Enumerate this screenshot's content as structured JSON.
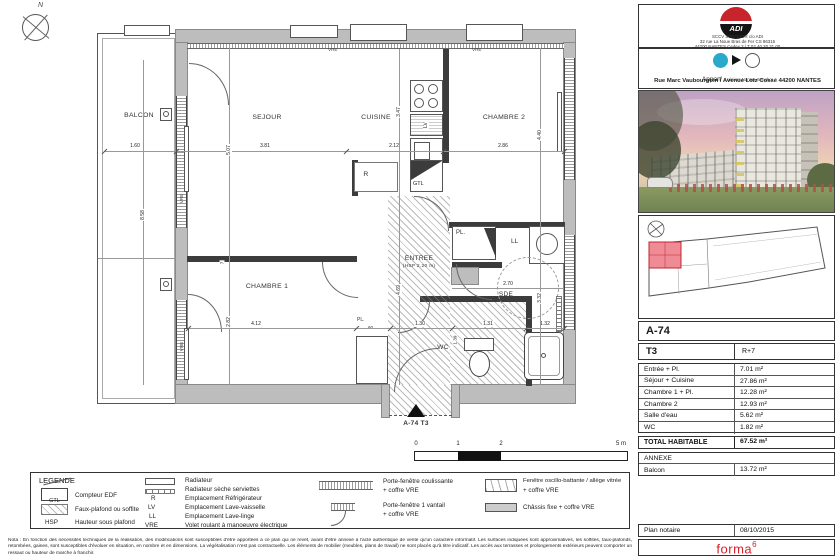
{
  "colors": {
    "accent_red": "#c8242c",
    "unit_highlight": "#ef8b95",
    "firm_red": "#d6212b"
  },
  "plan": {
    "north": "N",
    "rooms": {
      "balcon": "BALCON",
      "sejour": "SEJOUR",
      "cuisine": "CUISINE",
      "chambre2": "CHAMBRE 2",
      "chambre1": "CHAMBRE 1",
      "entree": "ENTREE",
      "entree_hsp": "(HSP 2.20 m)",
      "sde": "SDE",
      "wc": "WC",
      "pl_top": "PL.",
      "pl_bottom": "PL.",
      "pl_depth": "60",
      "ll": "LL",
      "refrigerator": "R",
      "lave_vaisselle": "LV",
      "gtl": "GTL"
    },
    "vre_label": "VRE",
    "dims": {
      "balcon_width": "1.60",
      "balcon_height": "8.58",
      "sejour_width": "3.81",
      "sejour_height": "5.07",
      "cuisine_width": "2.12",
      "cuisine_height": "3.47",
      "chambre2_width": "2.86",
      "chambre2_height": "4.40",
      "chambre1_width": "4.12",
      "chambre1_height": "2.82",
      "wall_offset": "7",
      "entree_height": "4.69",
      "entree_width": "1.30",
      "sde_width": "2.70",
      "sde_height": "3.32",
      "wc_width": "1.31",
      "wc_height": "1.39",
      "douche_width": "1.32"
    },
    "marker_label": "A-74 T3",
    "scale_ticks": [
      "0",
      "1",
      "2",
      "5 m"
    ]
  },
  "legend": {
    "title": "LEGENDE",
    "gtl_symbol": "GTL",
    "col1": [
      {
        "abbr": "",
        "label": "Compteur EDF"
      },
      {
        "abbr": "",
        "label": "Faux-plafond ou soffite"
      },
      {
        "abbr": "HSP",
        "label": "Hauteur sous plafond"
      }
    ],
    "col2": [
      {
        "abbr": "",
        "label": "Radiateur"
      },
      {
        "abbr": "",
        "label": "Radiateur sèche serviettes"
      },
      {
        "abbr": "R",
        "label": "Emplacement Réfrigérateur"
      },
      {
        "abbr": "LV",
        "label": "Emplacement Lave-vaisselle"
      },
      {
        "abbr": "LL",
        "label": "Emplacement Lave-linge"
      },
      {
        "abbr": "VRE",
        "label": "Volet roulant à manoeuvre électrique"
      }
    ],
    "col3": [
      {
        "line1": "Porte-fenêtre coulissante",
        "line2": "+ coffre VRE"
      },
      {
        "line1": "Porte-fenêtre 1 vantail",
        "line2": "+ coffre VRE"
      }
    ],
    "col4": [
      {
        "line1": "Fenêtre oscillo-battante / allège vitrée",
        "line2": "+ coffre VRE"
      },
      {
        "line1": "Châssis fixe + coffre VRE",
        "line2": ""
      }
    ]
  },
  "note": "Nota : En fonction des nécessités techniques de la réalisation, des modifications sont susceptibles d'être apportées à ce plan qui ne revêt, avant d'être annexé à l'acte authentique de vente qu'un caractère informatif. Les surfaces indiquées sont approximatives, les soffites, faux-plafonds, retombées, gaines, sont susceptibles d'évoluer en situation, en nombre et en dimensions. La végétalisation n'est pas contractuelle. Les éléments de mobilier (meubles, plans de travail) ne sont placés qu'à titre indicatif. Les accès aux terrasses et prolongements extérieurs peuvent comporter un ressaut ou hauteur de marche à franchir.",
  "panel": {
    "logo": "ADI",
    "company_line1": "SCCV SENGHOR c/o ADI",
    "company_line2": "32 rue La Noue Bras de Fer CS 86316",
    "company_line3": "44200 NANTES Cedex 2 | T 02 40 20 21 00",
    "brand": "Appart'",
    "brand_sub": "séniors Nantes-Senghor",
    "address": "Rue Marc Vaubourgoin / Avenue Lotz Cossé 44200 NANTES",
    "unit_code": "A-74",
    "unit_type": "T3",
    "unit_floor": "R+7",
    "areas": [
      {
        "label": "Entrée + Pl.",
        "value": "7.01 m²"
      },
      {
        "label": "Séjour + Cuisine",
        "value": "27.86 m²"
      },
      {
        "label": "Chambre 1 + Pl.",
        "value": "12.28 m²"
      },
      {
        "label": "Chambre 2",
        "value": "12.93 m²"
      },
      {
        "label": "Salle d'eau",
        "value": "5.62 m²"
      },
      {
        "label": "WC",
        "value": "1.82 m²"
      }
    ],
    "total_label": "TOTAL HABITABLE",
    "total_value": "67.52 m²",
    "annexe_title": "ANNEXE",
    "annexe_rows": [
      {
        "label": "Balcon",
        "value": "13.72 m²"
      }
    ],
    "notaire_label": "Plan notaire",
    "notaire_value": "08/10/2015",
    "firm": "forma",
    "firm_sup": "6"
  }
}
